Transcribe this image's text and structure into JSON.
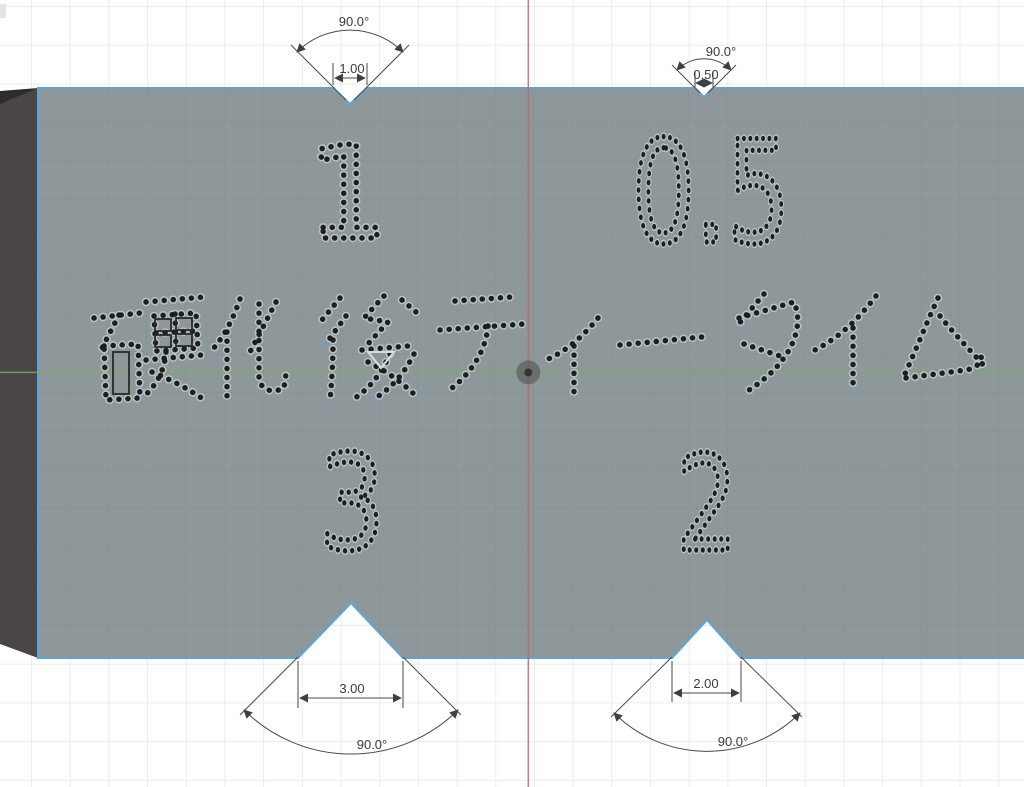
{
  "engravings": {
    "top_left": "1",
    "top_right": "0.5",
    "center": "硬化後ティータイム",
    "bottom_left": "3",
    "bottom_right": "2"
  },
  "dimensions": {
    "top_left_notch": {
      "angle": "90.0°",
      "width": "1.00"
    },
    "top_right_notch": {
      "angle": "90.0°",
      "width": "0.50"
    },
    "bottom_left_notch": {
      "angle": "90.0°",
      "width": "3.00"
    },
    "bottom_right_notch": {
      "angle": "90.0°",
      "width": "2.00"
    }
  },
  "colors": {
    "background": "#ffffff",
    "grid": "#ececec",
    "plate_face": "#8e989a",
    "plate_side": "#4a4645",
    "sketch_blue": "#5aa7d7",
    "point_dot": "#1f1f1f",
    "point_halo": "#c4cbcb",
    "dimension": "#3a3a3a",
    "axis_vertical_red": "#c4655c",
    "axis_horizontal_green": "#79ad62"
  }
}
